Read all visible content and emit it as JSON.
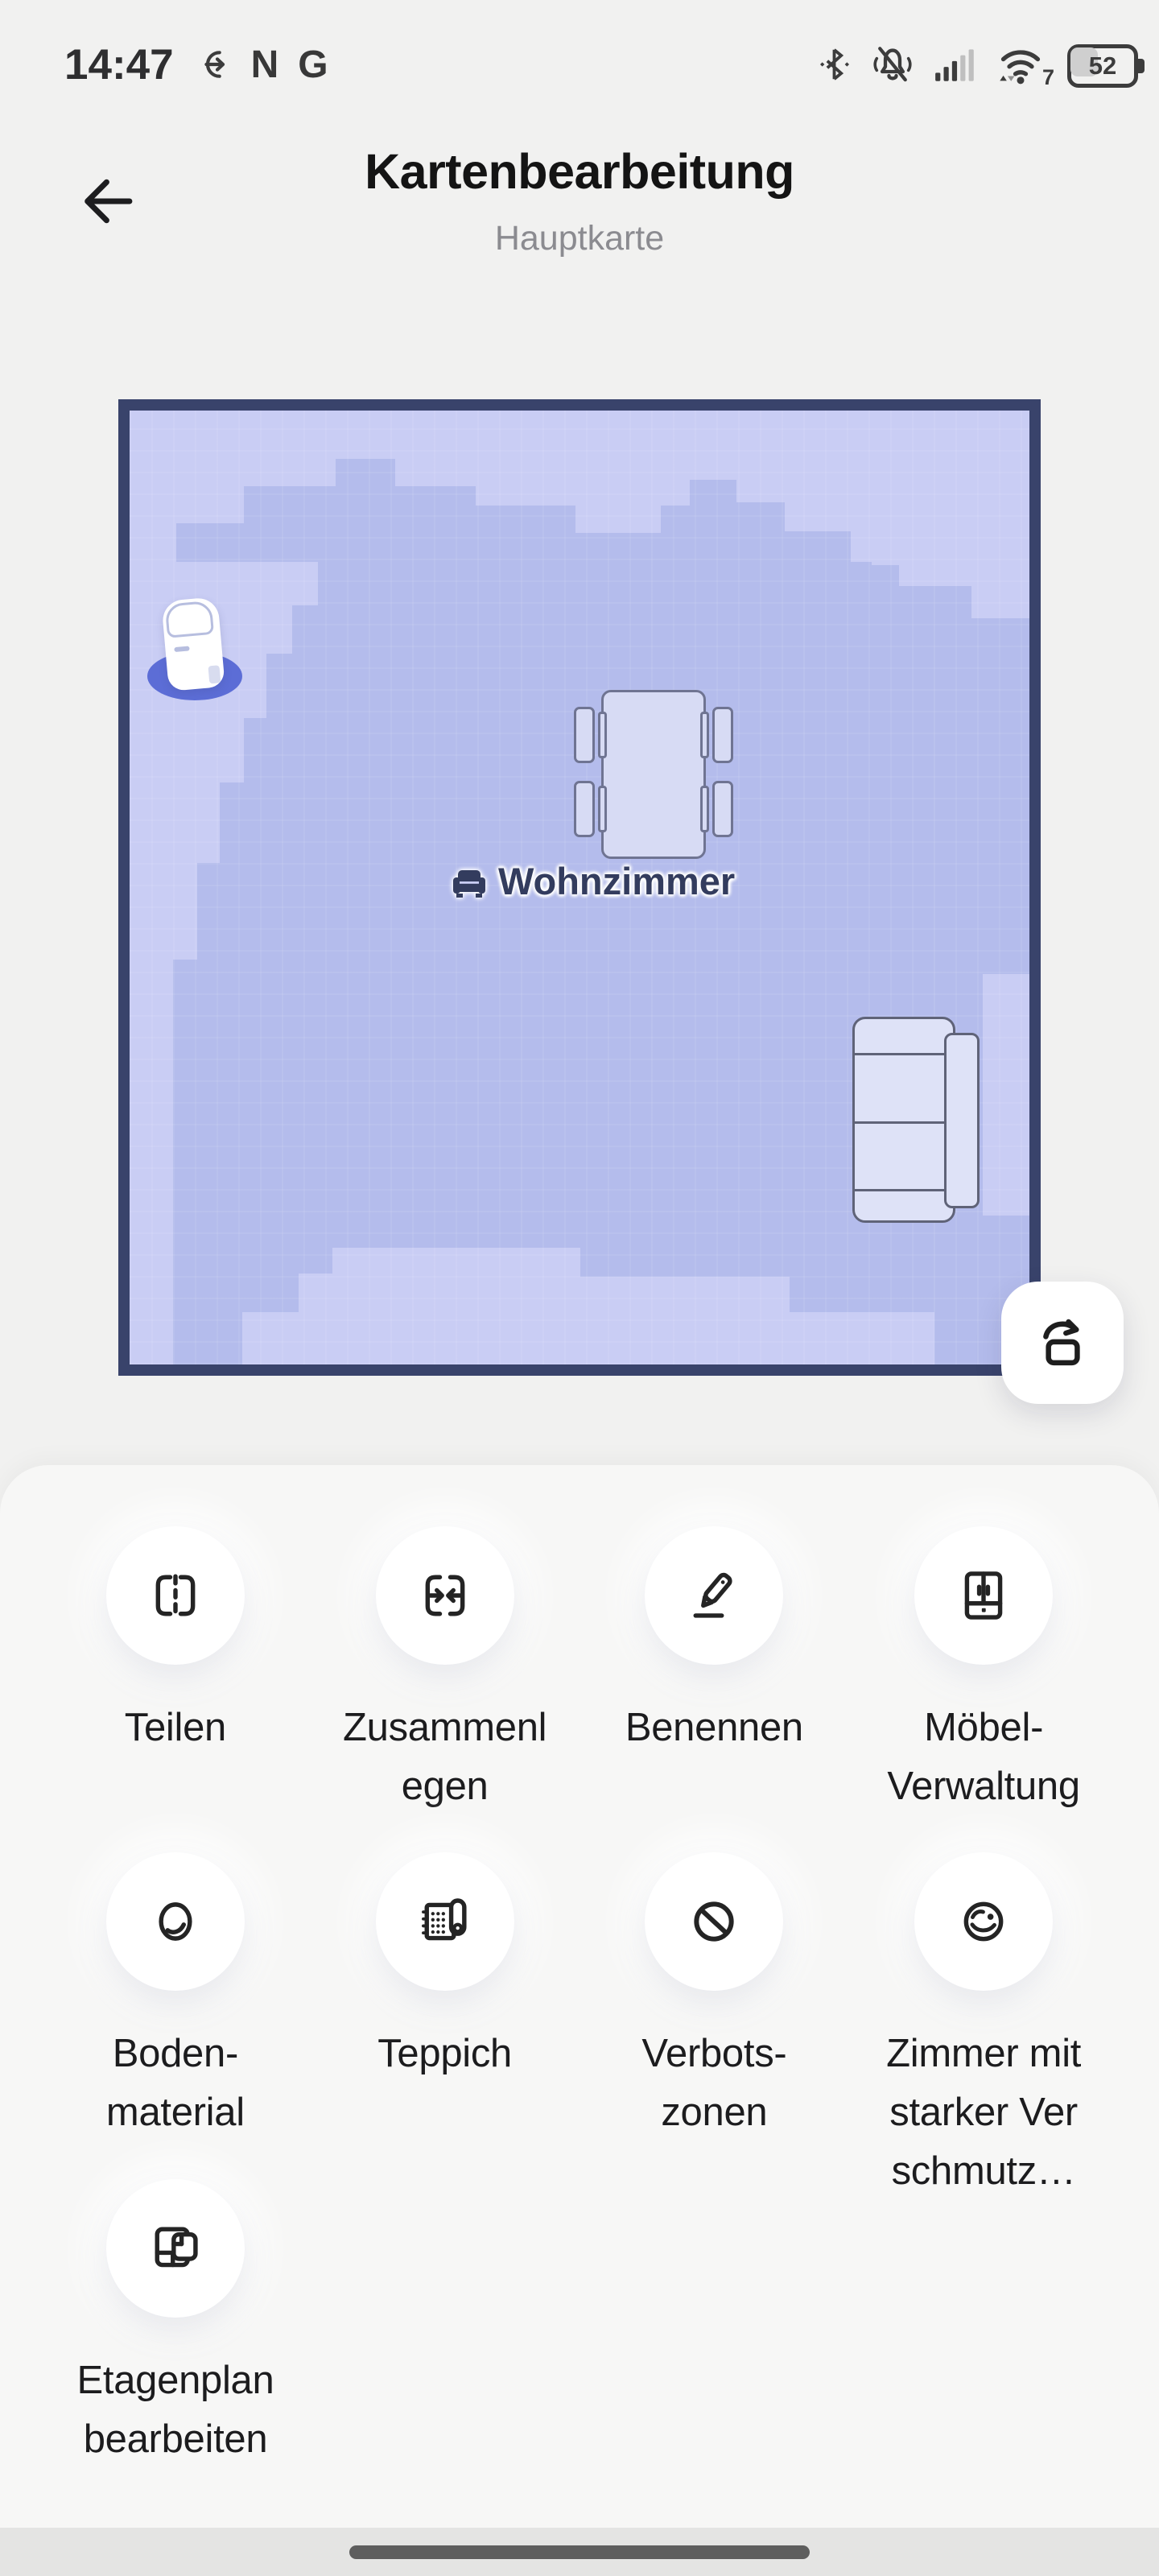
{
  "status_bar": {
    "time": "14:47",
    "nfc_label": "N",
    "app_badge": "G",
    "wifi_generation": "7",
    "battery_percent": "52"
  },
  "header": {
    "title": "Kartenbearbeitung",
    "subtitle": "Hauptkarte"
  },
  "map": {
    "room_label": "Wohnzimmer",
    "colors": {
      "border": "#39436b",
      "floor": "#b4bcec",
      "floor_light": "#c9cdf4",
      "dock_ring": "#5c6dd6",
      "room_text": "#333c5e"
    }
  },
  "rotate_button": {
    "icon": "rotate-map-icon"
  },
  "actions": [
    {
      "label": "Teilen",
      "icon": "split-map-icon"
    },
    {
      "label": "Zusammenl\negen",
      "icon": "merge-map-icon"
    },
    {
      "label": "Benennen",
      "icon": "rename-icon"
    },
    {
      "label": "Möbel-\nVerwaltung",
      "icon": "furniture-management-icon"
    },
    {
      "label": "Boden-\nmaterial",
      "icon": "floor-material-icon"
    },
    {
      "label": "Teppich",
      "icon": "carpet-icon"
    },
    {
      "label": "Verbots-\nzonen",
      "icon": "no-go-zone-icon"
    },
    {
      "label": "Zimmer mit\nstarker Ver\nschmutz…",
      "icon": "heavy-dirt-room-icon"
    },
    {
      "label": "Etagenplan\nbearbeiten",
      "icon": "floor-plan-edit-icon"
    }
  ]
}
